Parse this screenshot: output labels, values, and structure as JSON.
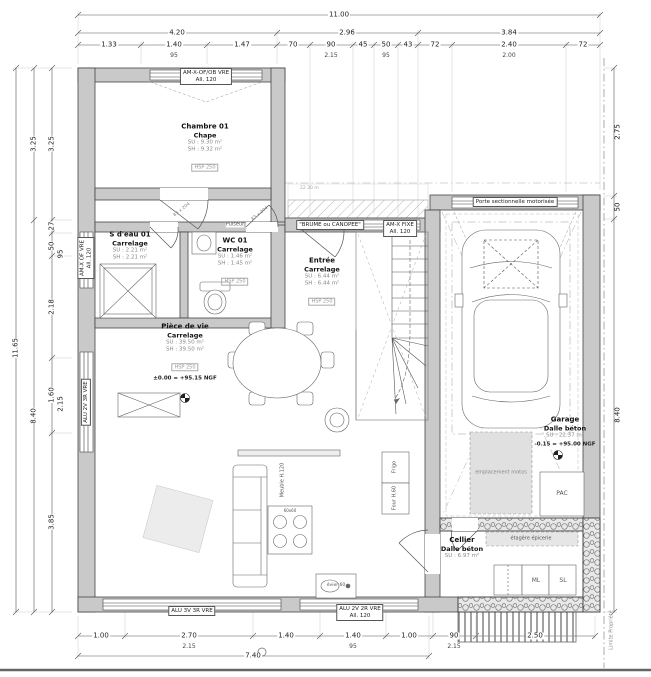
{
  "drawing_type": "floor-plan",
  "colors": {
    "line": "#444444",
    "wall_fill": "#c9c9c9",
    "hatch": "#aaaaaa",
    "shade_fill": "#e0e0e0",
    "text": "#222222",
    "subtext": "#888888"
  },
  "dims": {
    "top_total": "11.00",
    "top_row2": [
      "4.20",
      "2.96",
      "3.84"
    ],
    "top_row3": [
      "1.33",
      "1.40",
      "1.47",
      "70",
      "90",
      "45",
      "50",
      "43",
      "72",
      "2.40",
      "72"
    ],
    "top_sub": [
      "95",
      "2.15",
      "95",
      "2.00"
    ],
    "left_total": "11.65",
    "left_col2": [
      "3.25",
      "8.40"
    ],
    "left_col3": [
      "3.25",
      "27",
      "50",
      "2.18",
      "1.60",
      "3.85"
    ],
    "left_sub": [
      "95",
      "2.15"
    ],
    "right_col": [
      "2.75",
      "50",
      "8.40"
    ],
    "bottom_row": [
      "1.00",
      "2.70",
      "1.40",
      "1.40",
      "1.00",
      "90",
      "2.50"
    ],
    "bottom_sub": [
      "2.15",
      "95",
      "2.15"
    ],
    "bottom_total": "7.40"
  },
  "rooms": {
    "chambre": {
      "name": "Chambre 01",
      "floor": "Chape",
      "su": "SU : 9.30 m²",
      "sh": "SH : 9.32 m²",
      "hsp": "HSP 250"
    },
    "sdeau": {
      "name": "S d'eau 01",
      "floor": "Carrelage",
      "su": "SU : 2.21 m²",
      "sh": "SH : 2.21 m²",
      "hsp": "HSP 250"
    },
    "wc": {
      "name": "WC 01",
      "floor": "Carrelage",
      "su": "SU : 1.46 m²",
      "sh": "SH : 1.45 m²",
      "hsp": "HSP 250"
    },
    "entree": {
      "name": "Entrée",
      "floor": "Carrelage",
      "su": "SU : 6.44 m²",
      "sh": "SH : 6.44 m²",
      "hsp": "HSP 250"
    },
    "vie": {
      "name": "Pièce de vie",
      "floor": "Carrelage",
      "su": "SU : 39.50 m²",
      "sh": "SH : 39.50 m²",
      "hsp": "HSP 250",
      "level": "±0.00 = +95.15 NGF"
    },
    "garage": {
      "name": "Garage",
      "floor": "Dalle béton",
      "su": "SU : 22.37 m²",
      "level": "-0.15 = +95.00 NGF"
    },
    "cellier": {
      "name": "Cellier",
      "floor": "Dalle béton",
      "su": "SU : 6.97 m²"
    }
  },
  "openings": {
    "chambre_window": {
      "l1": "AM-X-OF/OB VRE",
      "l2": "All. 120"
    },
    "entree_window": {
      "l1": "\"BRUME ou CANOPEE\"",
      "l2": "AM-X FIXE",
      "l3": "All. 120"
    },
    "garage_door": "Porte sectionnelle motorisée",
    "south_window_big": "ALU 3V 3R VRE",
    "south_window_small": {
      "l1": "ALU 2V 2R VRE",
      "l2": "All. 120"
    },
    "west_window_living": "ALU 2V 3R VRE",
    "west_window_sdeau": {
      "l1": "AM-X OF VRE",
      "l2": "All. 120"
    }
  },
  "annotations": {
    "motos": "emplacement motos",
    "pac": "PAC",
    "ml": "ML",
    "sl": "SL",
    "frigo": "Frigo",
    "four": "Four H.60",
    "evier": "évier 60",
    "cooktop": "60x60",
    "meuble": "Meuble H.120",
    "pulseur": "Pulseur",
    "etagere": "étagère épicerie",
    "door_size": "83 x 204",
    "porch_note": "22.30 m",
    "limite": "Limite Propriété"
  }
}
